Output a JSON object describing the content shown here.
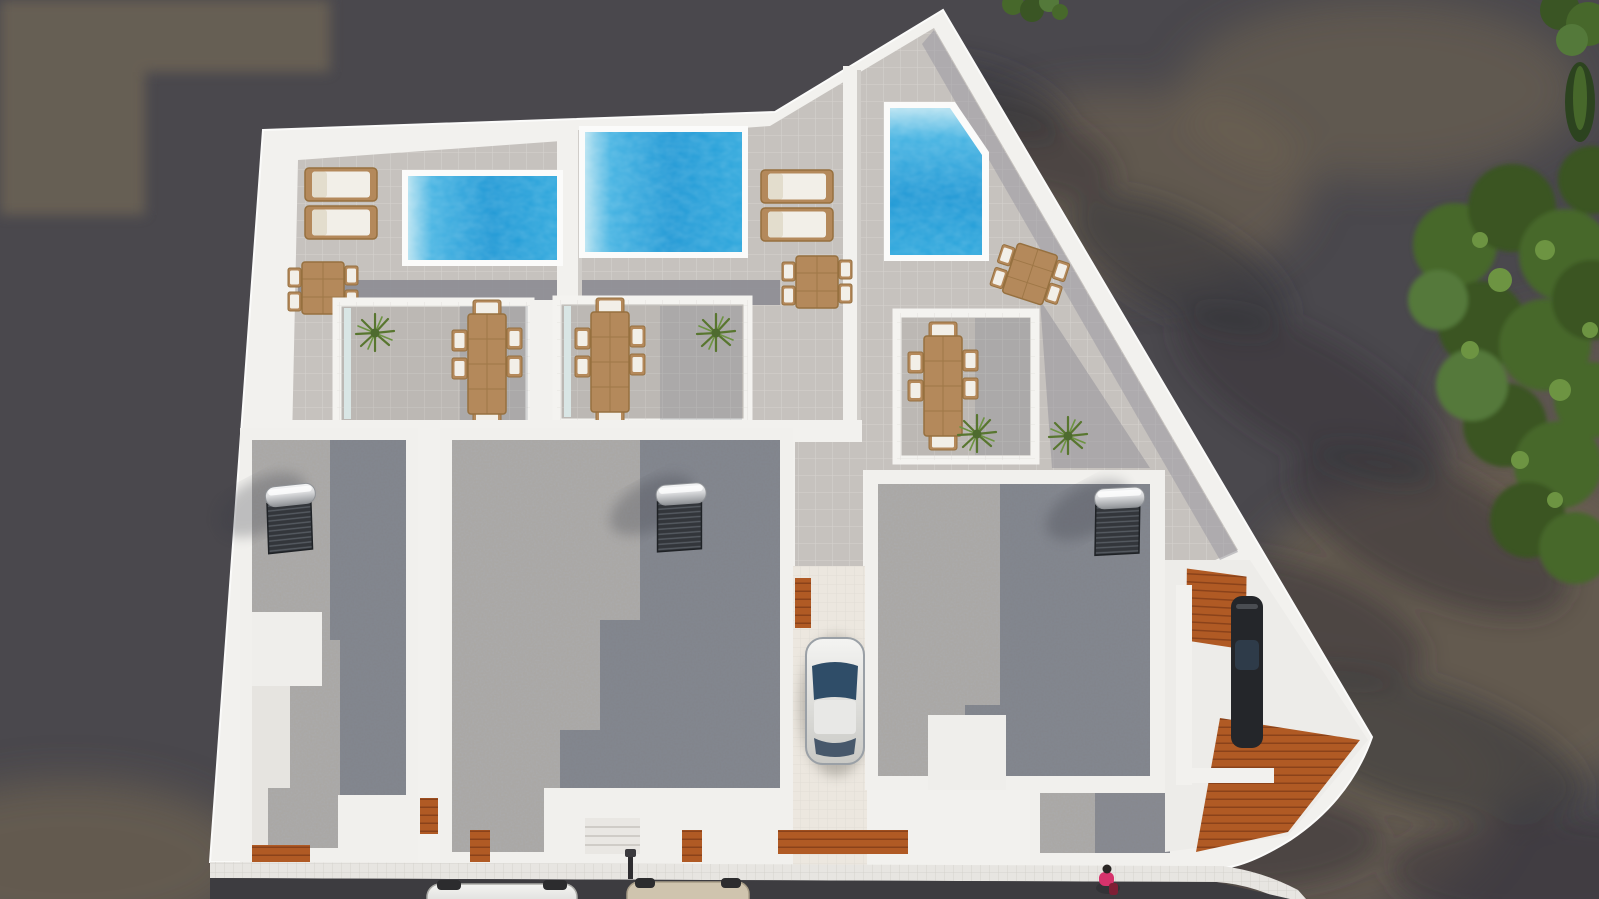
{
  "scene": {
    "kind": "aerial-3d-architectural-render",
    "view": "top-down",
    "subject": "triplex villa complex with rooftop pools, tiled sun terraces, gravel flat roofs, driveway and street parking",
    "lighting": "daylight with long leafy tree shadows on asphalt"
  },
  "palette": {
    "asphalt": "#4a484d",
    "asphalt_warm": "#756753",
    "asphalt_warm2": "#6b6255",
    "road": "#3d3c40",
    "shadow_blob": "#35343a",
    "wall_white": "#f2f1ee",
    "wall_bright": "#fbfbfa",
    "wall_shade": "#dcd9d5",
    "tile_light": "#c6c2be",
    "tile_grout": "#d8d5d1",
    "tile_shaded": "#8f8e95",
    "terrace_floor": "#bcb8b4",
    "sidewalk": "#e7e5e1",
    "pool_deep": "#1f98d5",
    "pool_mid": "#45b3e2",
    "pool_shelf": "#b5e2f1",
    "gravel": "#a9a6a1",
    "gravel_shadow": "#535a6e",
    "wood_furniture": "#b4895b",
    "wood_furniture_dark": "#96703f",
    "cushion": "#f2efe8",
    "deck_wood": "#b05a24",
    "deck_wood_dark": "#8a421a",
    "glass": "#d9e6e5",
    "plant_green": "#4e6b2f",
    "tree_dark": "#3a5524",
    "tree_mid": "#47682b",
    "tree_light": "#6d9442",
    "car_white": "#ececea",
    "car_champagne": "#cfc4ae",
    "car_silver": "#e2e2df",
    "car_dark": "#24262a",
    "windshield": "#2f4d68",
    "rear_window": "#47586b",
    "solar_panel": "#33363b",
    "solar_tank": "#d9dadc",
    "person_top": "#d6336c",
    "person_bag": "#7e1f35"
  },
  "inventory": {
    "villas": 3,
    "rooftop_pools": 3,
    "sun_loungers": 4,
    "dining_tables_large_6_seat": 3,
    "dining_tables_small_4_seat": 3,
    "solar_water_heaters": 3,
    "potted_plants": 4,
    "street_cars": 2,
    "driveway_car": 1,
    "carport_car": 1,
    "pedestrians": 1,
    "trees_right_edge": 3,
    "wood_deck_areas": 5
  }
}
